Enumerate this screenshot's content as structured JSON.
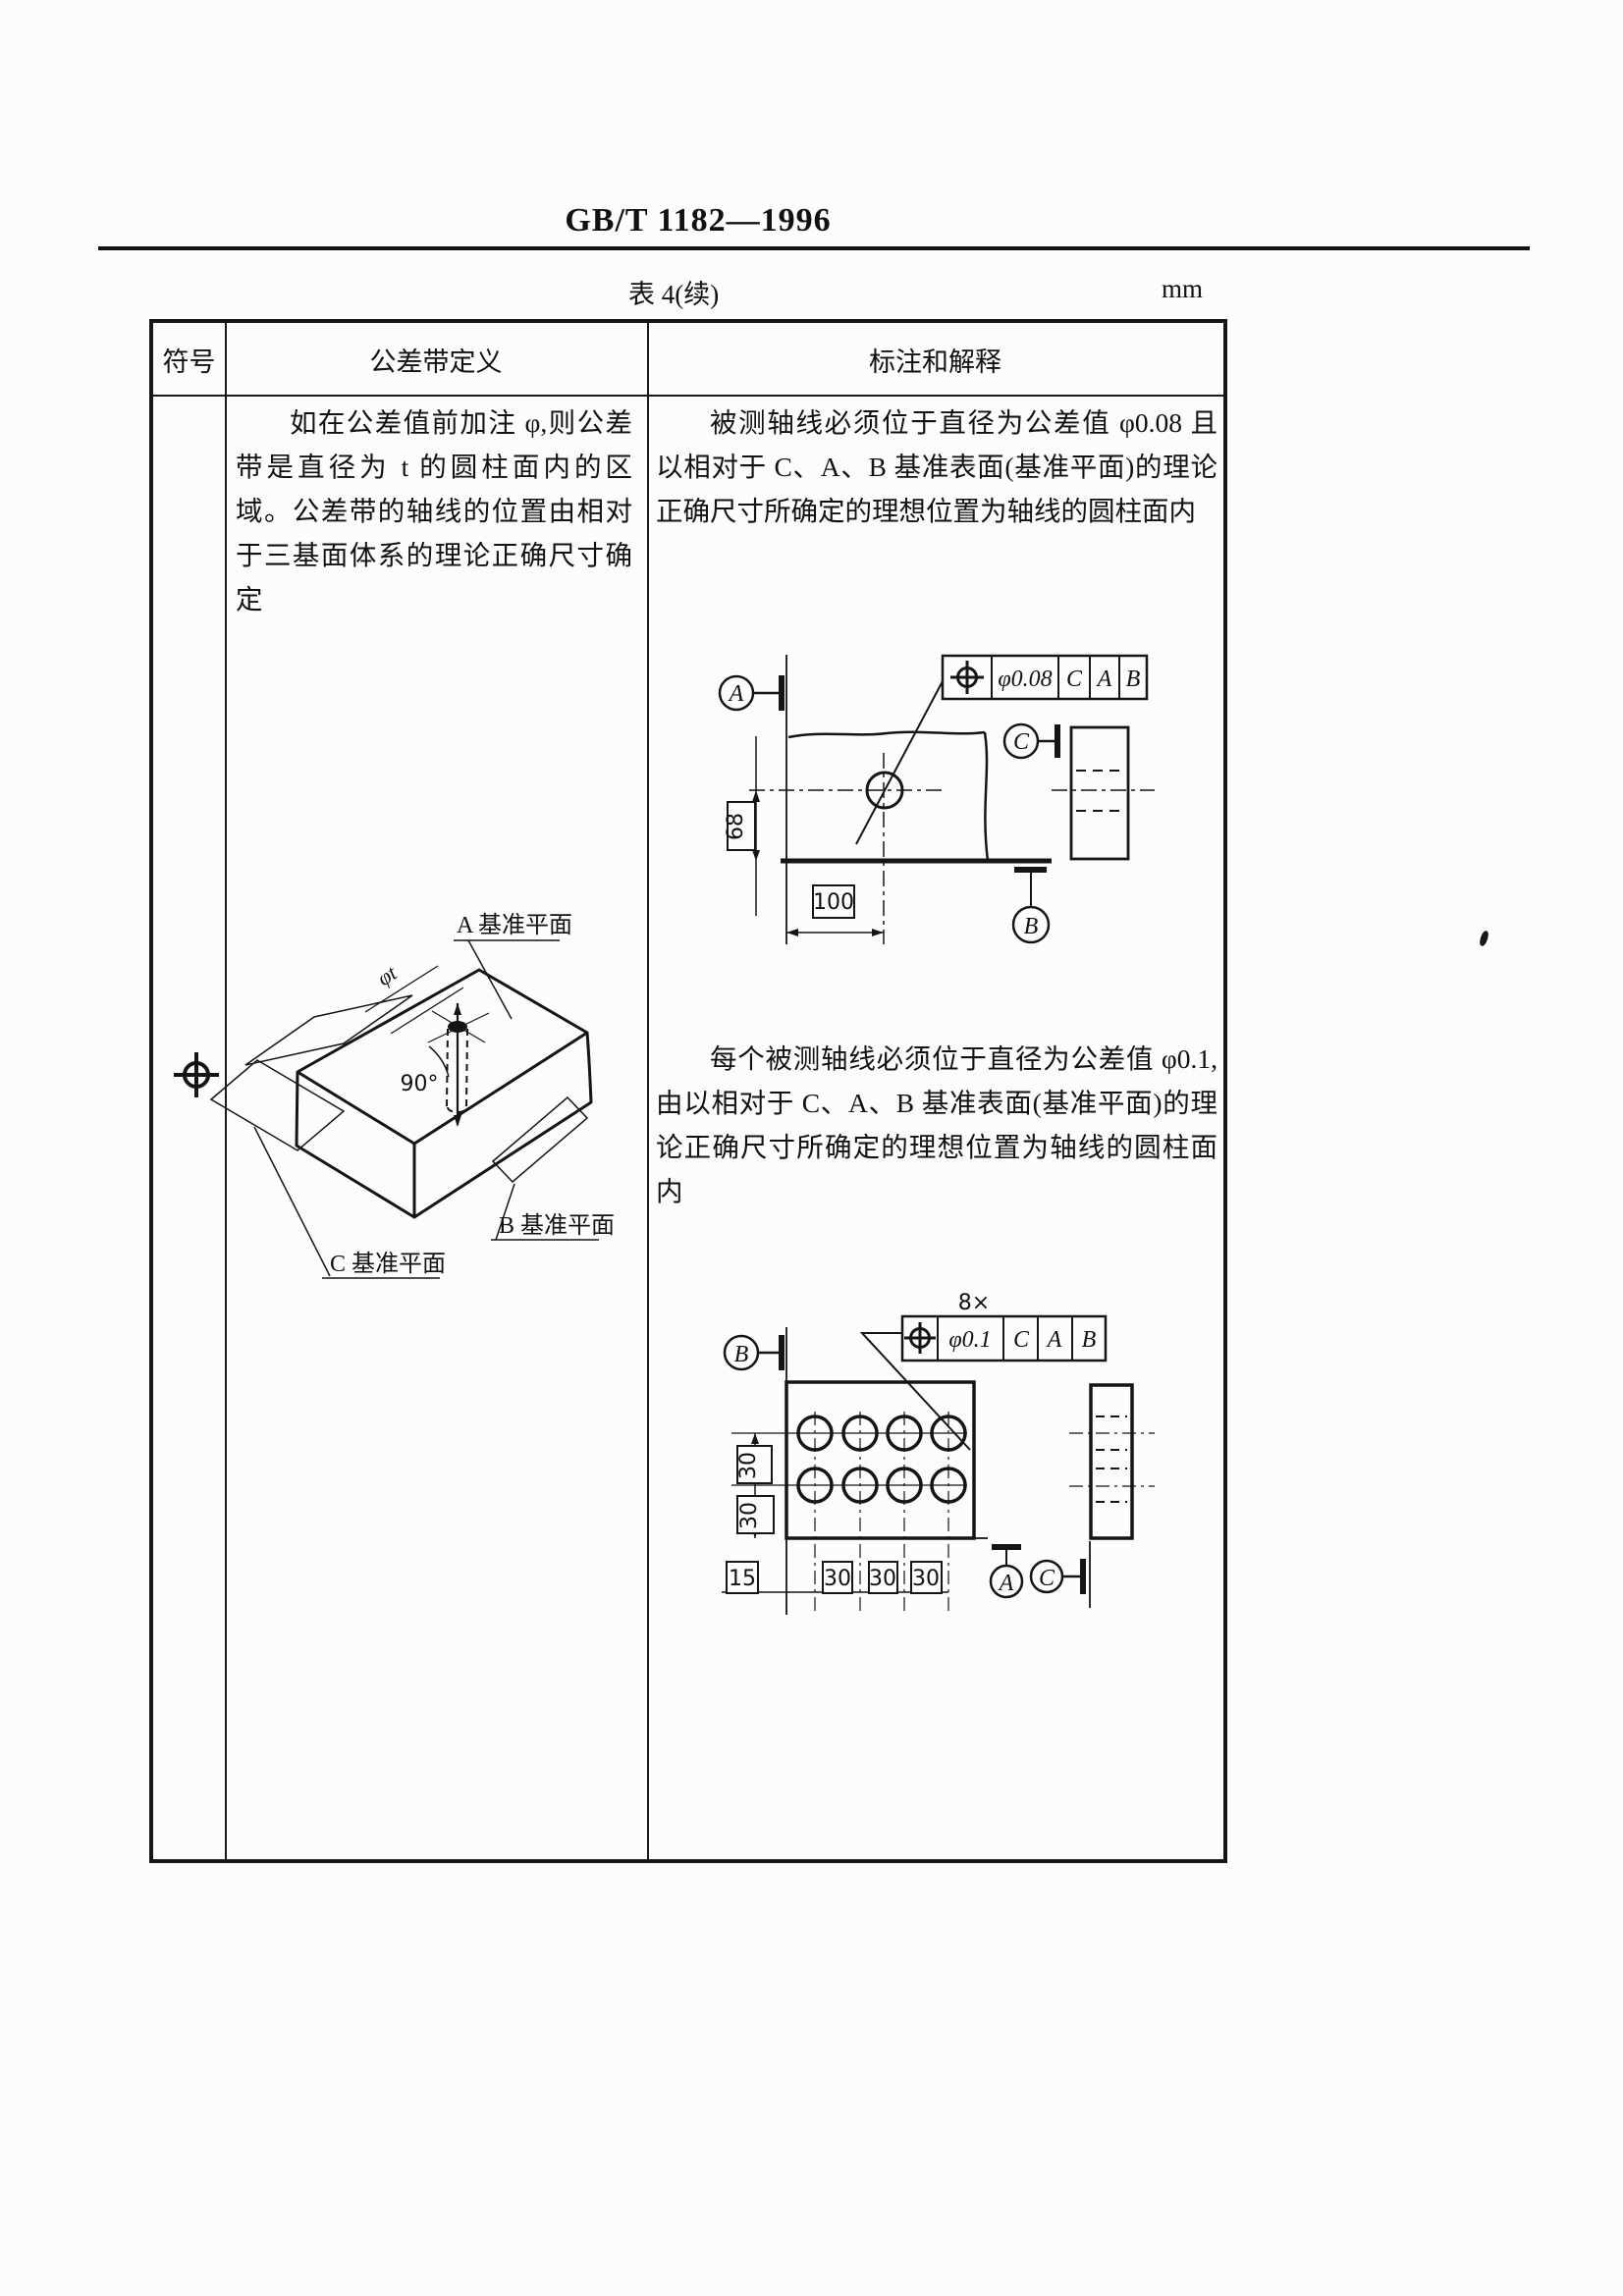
{
  "page": {
    "header_title": "GB/T 1182—1996",
    "table_caption": "表 4(续)",
    "unit": "mm"
  },
  "table": {
    "headers": {
      "symbol": "符号",
      "definition": "公差带定义",
      "annotation": "标注和解释"
    },
    "symbol_icon": "position-tolerance-symbol",
    "definition_text": "如在公差值前加注 φ,则公差带是直径为 t 的圆柱面内的区域。公差带的轴线的位置由相对于三基面体系的理论正确尺寸确定",
    "annotation_text_1": "被测轴线必须位于直径为公差值 φ0.08 且以相对于 C、A、B 基准表面(基准平面)的理论正确尺寸所确定的理想位置为轴线的圆柱面内",
    "annotation_text_2": "每个被测轴线必须位于直径为公差值 φ0.1,由以相对于 C、A、B 基准表面(基准平面)的理论正确尺寸所确定的理想位置为轴线的圆柱面内"
  },
  "diagram_3d": {
    "label_phi_t": "φt",
    "label_angle": "90°",
    "label_datum_a": "A 基准平面",
    "label_datum_b": "B 基准平面",
    "label_datum_c": "C 基准平面"
  },
  "drawing1": {
    "fcf": {
      "symbol": "position-tolerance-symbol",
      "tolerance": "φ0.08",
      "d1": "C",
      "d2": "A",
      "d3": "B"
    },
    "datums": {
      "a": "A",
      "b": "B",
      "c": "C"
    },
    "dims": {
      "height": "68",
      "width": "100"
    }
  },
  "drawing2": {
    "count": "8×",
    "fcf": {
      "symbol": "position-tolerance-symbol",
      "tolerance": "φ0.1",
      "d1": "C",
      "d2": "A",
      "d3": "B"
    },
    "datums": {
      "a": "A",
      "b": "B",
      "c": "C"
    },
    "dims": {
      "v1": "30",
      "v2": "30",
      "h1": "15",
      "h2": "30",
      "h3": "30",
      "h4": "30"
    }
  }
}
